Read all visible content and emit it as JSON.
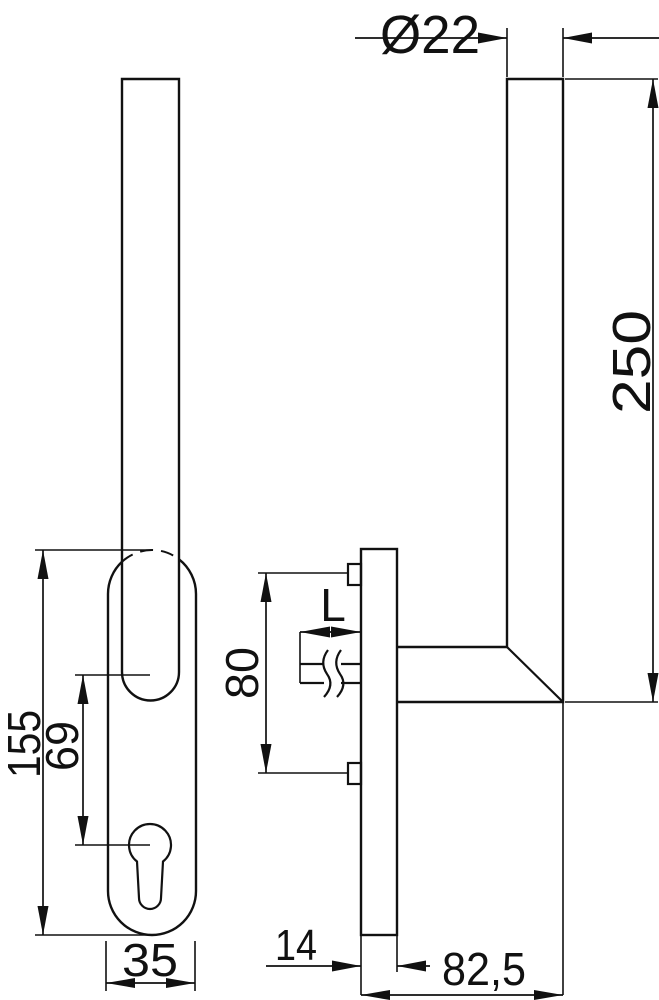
{
  "drawing": {
    "colors": {
      "line": "#111111",
      "background": "#ffffff"
    },
    "dimensions": {
      "tube_diameter": "Ø22",
      "handle_height": "250",
      "plate_height": "155",
      "axis_to_cylinder": "69",
      "plate_width": "35",
      "screw_spacing": "80",
      "spindle_length": "L",
      "plate_thickness": "14",
      "projection": "82,5"
    }
  }
}
